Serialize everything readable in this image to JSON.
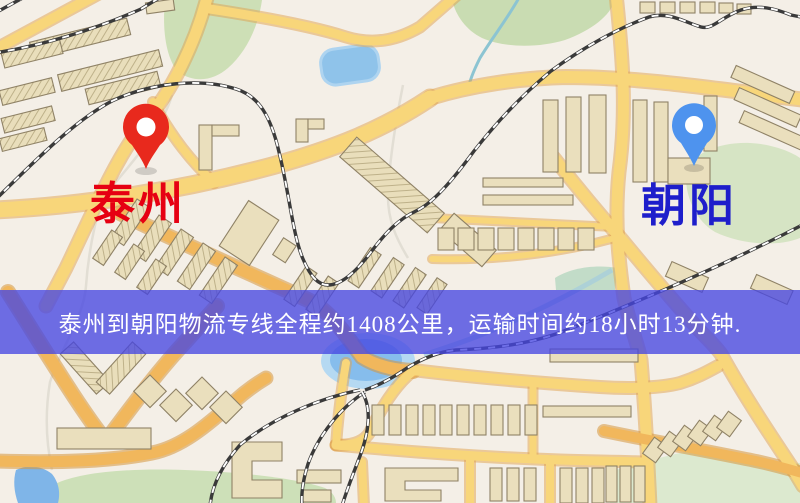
{
  "window": {
    "width": 800,
    "height": 503,
    "type": "logistics-route-map"
  },
  "map": {
    "origin": {
      "name": "泰州",
      "label_color": "#e60012",
      "pin_color": "#e8291d",
      "pin_style": "red-teardrop-marker"
    },
    "destination": {
      "name": "朝阳",
      "label_color": "#1e1ecb",
      "pin_color": "#4e93ee",
      "pin_style": "blue-teardrop-marker"
    },
    "banner": {
      "text": "泰州到朝阳物流专线全程约1408公里，运输时间约18小时13分钟.",
      "background_color": "#4646e1",
      "text_color": "#ffffff"
    },
    "route": {
      "from": "泰州",
      "to": "朝阳",
      "distance_text": "约1408公里",
      "duration_text": "约18小时13分钟"
    },
    "palette": {
      "background": "#f4efe7",
      "road_yellow": "#f8d67a",
      "road_orange": "#f1b75c",
      "building": "#eadfbd",
      "green_area": "#cfe0ba",
      "water": "#8fc3ea",
      "railway": "#3a3a3a"
    }
  }
}
